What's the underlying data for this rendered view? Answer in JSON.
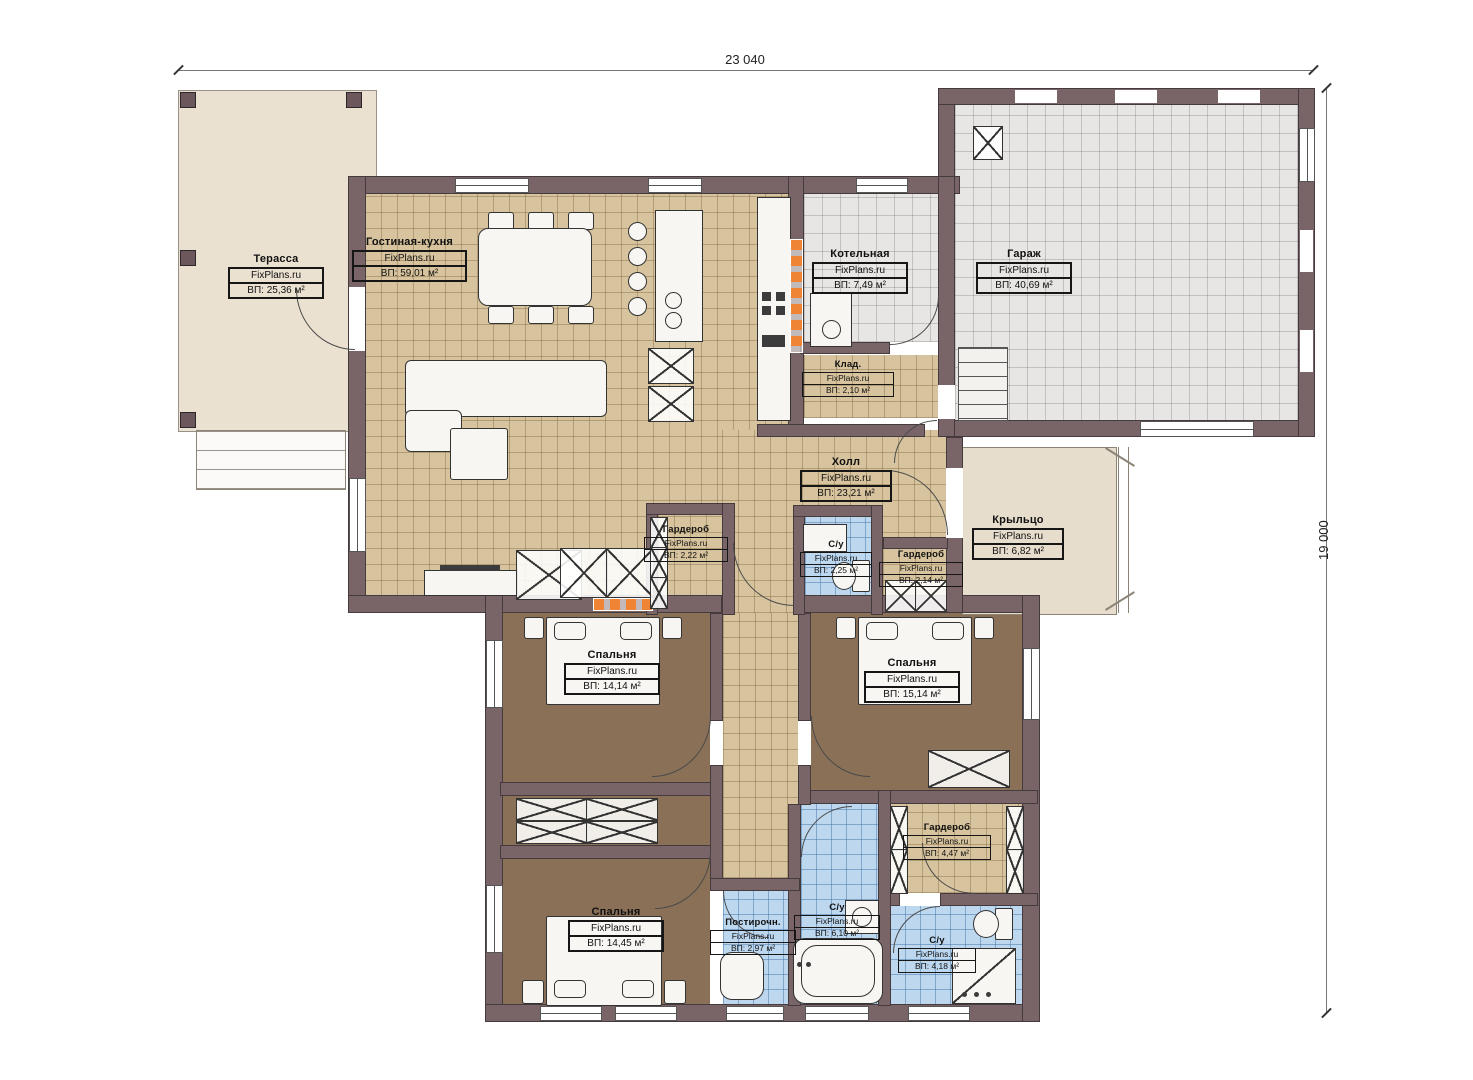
{
  "annotations": {
    "width": "23 040",
    "height": "19 000"
  },
  "watermark": "FixPlans.ru",
  "rooms": {
    "terrace": {
      "name": "Терасса",
      "area": "ВП: 25,36 м²"
    },
    "living": {
      "name": "Гостиная-кухня",
      "area": "ВП: 59,01 м²"
    },
    "boiler": {
      "name": "Котельная",
      "area": "ВП: 7,49 м²"
    },
    "garage": {
      "name": "Гараж",
      "area": "ВП: 40,69 м²"
    },
    "storage": {
      "name": "Клад.",
      "area": "ВП: 2,10 м²"
    },
    "hall": {
      "name": "Холл",
      "area": "ВП: 23,21 м²"
    },
    "wardrobe1": {
      "name": "Гардероб",
      "area": "ВП: 2,22 м²"
    },
    "wc1": {
      "name": "С/у",
      "area": "ВП: 2,25 м²"
    },
    "wardrobe2": {
      "name": "Гардероб",
      "area": "ВП: 2,14 м²"
    },
    "porch": {
      "name": "Крыльцо",
      "area": "ВП: 6,82 м²"
    },
    "bedroom1": {
      "name": "Спальня",
      "area": "ВП: 14,14 м²"
    },
    "bedroom2": {
      "name": "Спальня",
      "area": "ВП: 15,14 м²"
    },
    "wardrobe3": {
      "name": "Гардероб",
      "area": "ВП: 4,47 м²"
    },
    "bedroom3": {
      "name": "Спальня",
      "area": "ВП: 14,45 м²"
    },
    "laundry": {
      "name": "Постирочн.",
      "area": "ВП: 2,97 м²"
    },
    "wc2": {
      "name": "С/у",
      "area": "ВП: 6,10 м²"
    },
    "wc3": {
      "name": "С/у",
      "area": "ВП: 4,18 м²"
    }
  },
  "colors": {
    "wall": "#796468",
    "tile_beige": "#d7c49e",
    "floor_brown": "#8a7057",
    "tile_blue": "#bdd7ef",
    "tile_gray": "#e7e6e4",
    "terrace": "#eae1d1",
    "accent_orange": "#f08435"
  }
}
